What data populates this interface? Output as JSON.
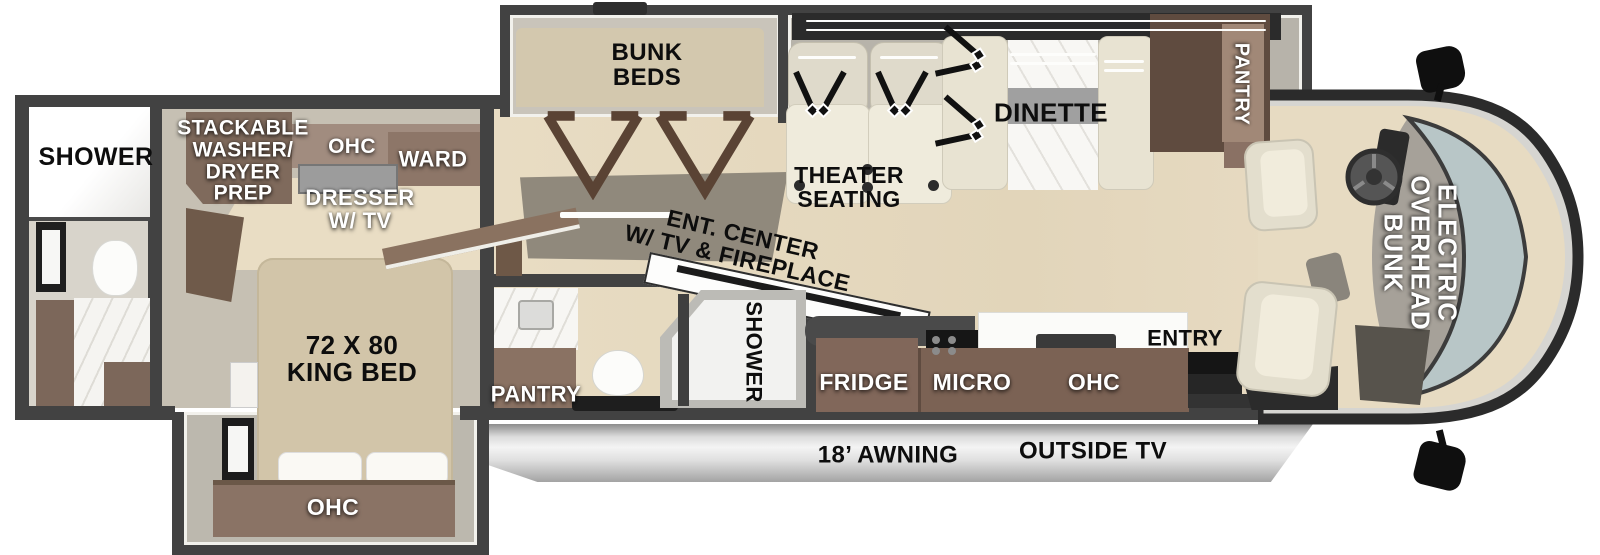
{
  "palette": {
    "wall": "#424242",
    "wood_floor": "#e7dbc2",
    "bedroom_floor": "#c6c0b3",
    "bath_floor": "#d8d4cb",
    "cabinet_brown": "#7d6557",
    "cabinet_light": "#a18c7f",
    "bed_tan": "#d2c5a9",
    "seat_cream": "#ece7d7",
    "marble": "#f6f5f2",
    "windshield": "#b8c6c7",
    "awning_silver": "#dcdcdc"
  },
  "rear_bath": {
    "shower_label": "SHOWER"
  },
  "bedroom": {
    "stackable_lines": [
      "STACKABLE",
      "WASHER/",
      "DRYER",
      "PREP"
    ],
    "ohc_label": "OHC",
    "ward_label": "WARD",
    "dresser_lines": [
      "DRESSER",
      "W/ TV"
    ],
    "king_bed_lines": [
      "72 X 80",
      "KING BED"
    ],
    "foot_ohc_label": "OHC"
  },
  "bunk_room": {
    "bunk_lines": [
      "BUNK",
      "BEDS"
    ]
  },
  "living": {
    "theater_lines": [
      "THEATER",
      "SEATING"
    ],
    "dinette_label": "DINETTE",
    "pantry_label": "PANTRY",
    "ent_lines": [
      "ENT. CENTER",
      "W/ TV & FIREPLACE"
    ]
  },
  "mid_bath": {
    "shower_label": "SHOWER",
    "pantry_label": "PANTRY"
  },
  "kitchen": {
    "fridge_label": "FRIDGE",
    "micro_label": "MICRO",
    "ohc_label": "OHC",
    "entry_label": "ENTRY"
  },
  "exterior": {
    "awning_label": "18’ AWNING",
    "outside_tv_label": "OUTSIDE TV"
  },
  "cab": {
    "overhead_bunk_lines": [
      "ELECTRIC",
      "OVERHEAD",
      "BUNK"
    ]
  }
}
